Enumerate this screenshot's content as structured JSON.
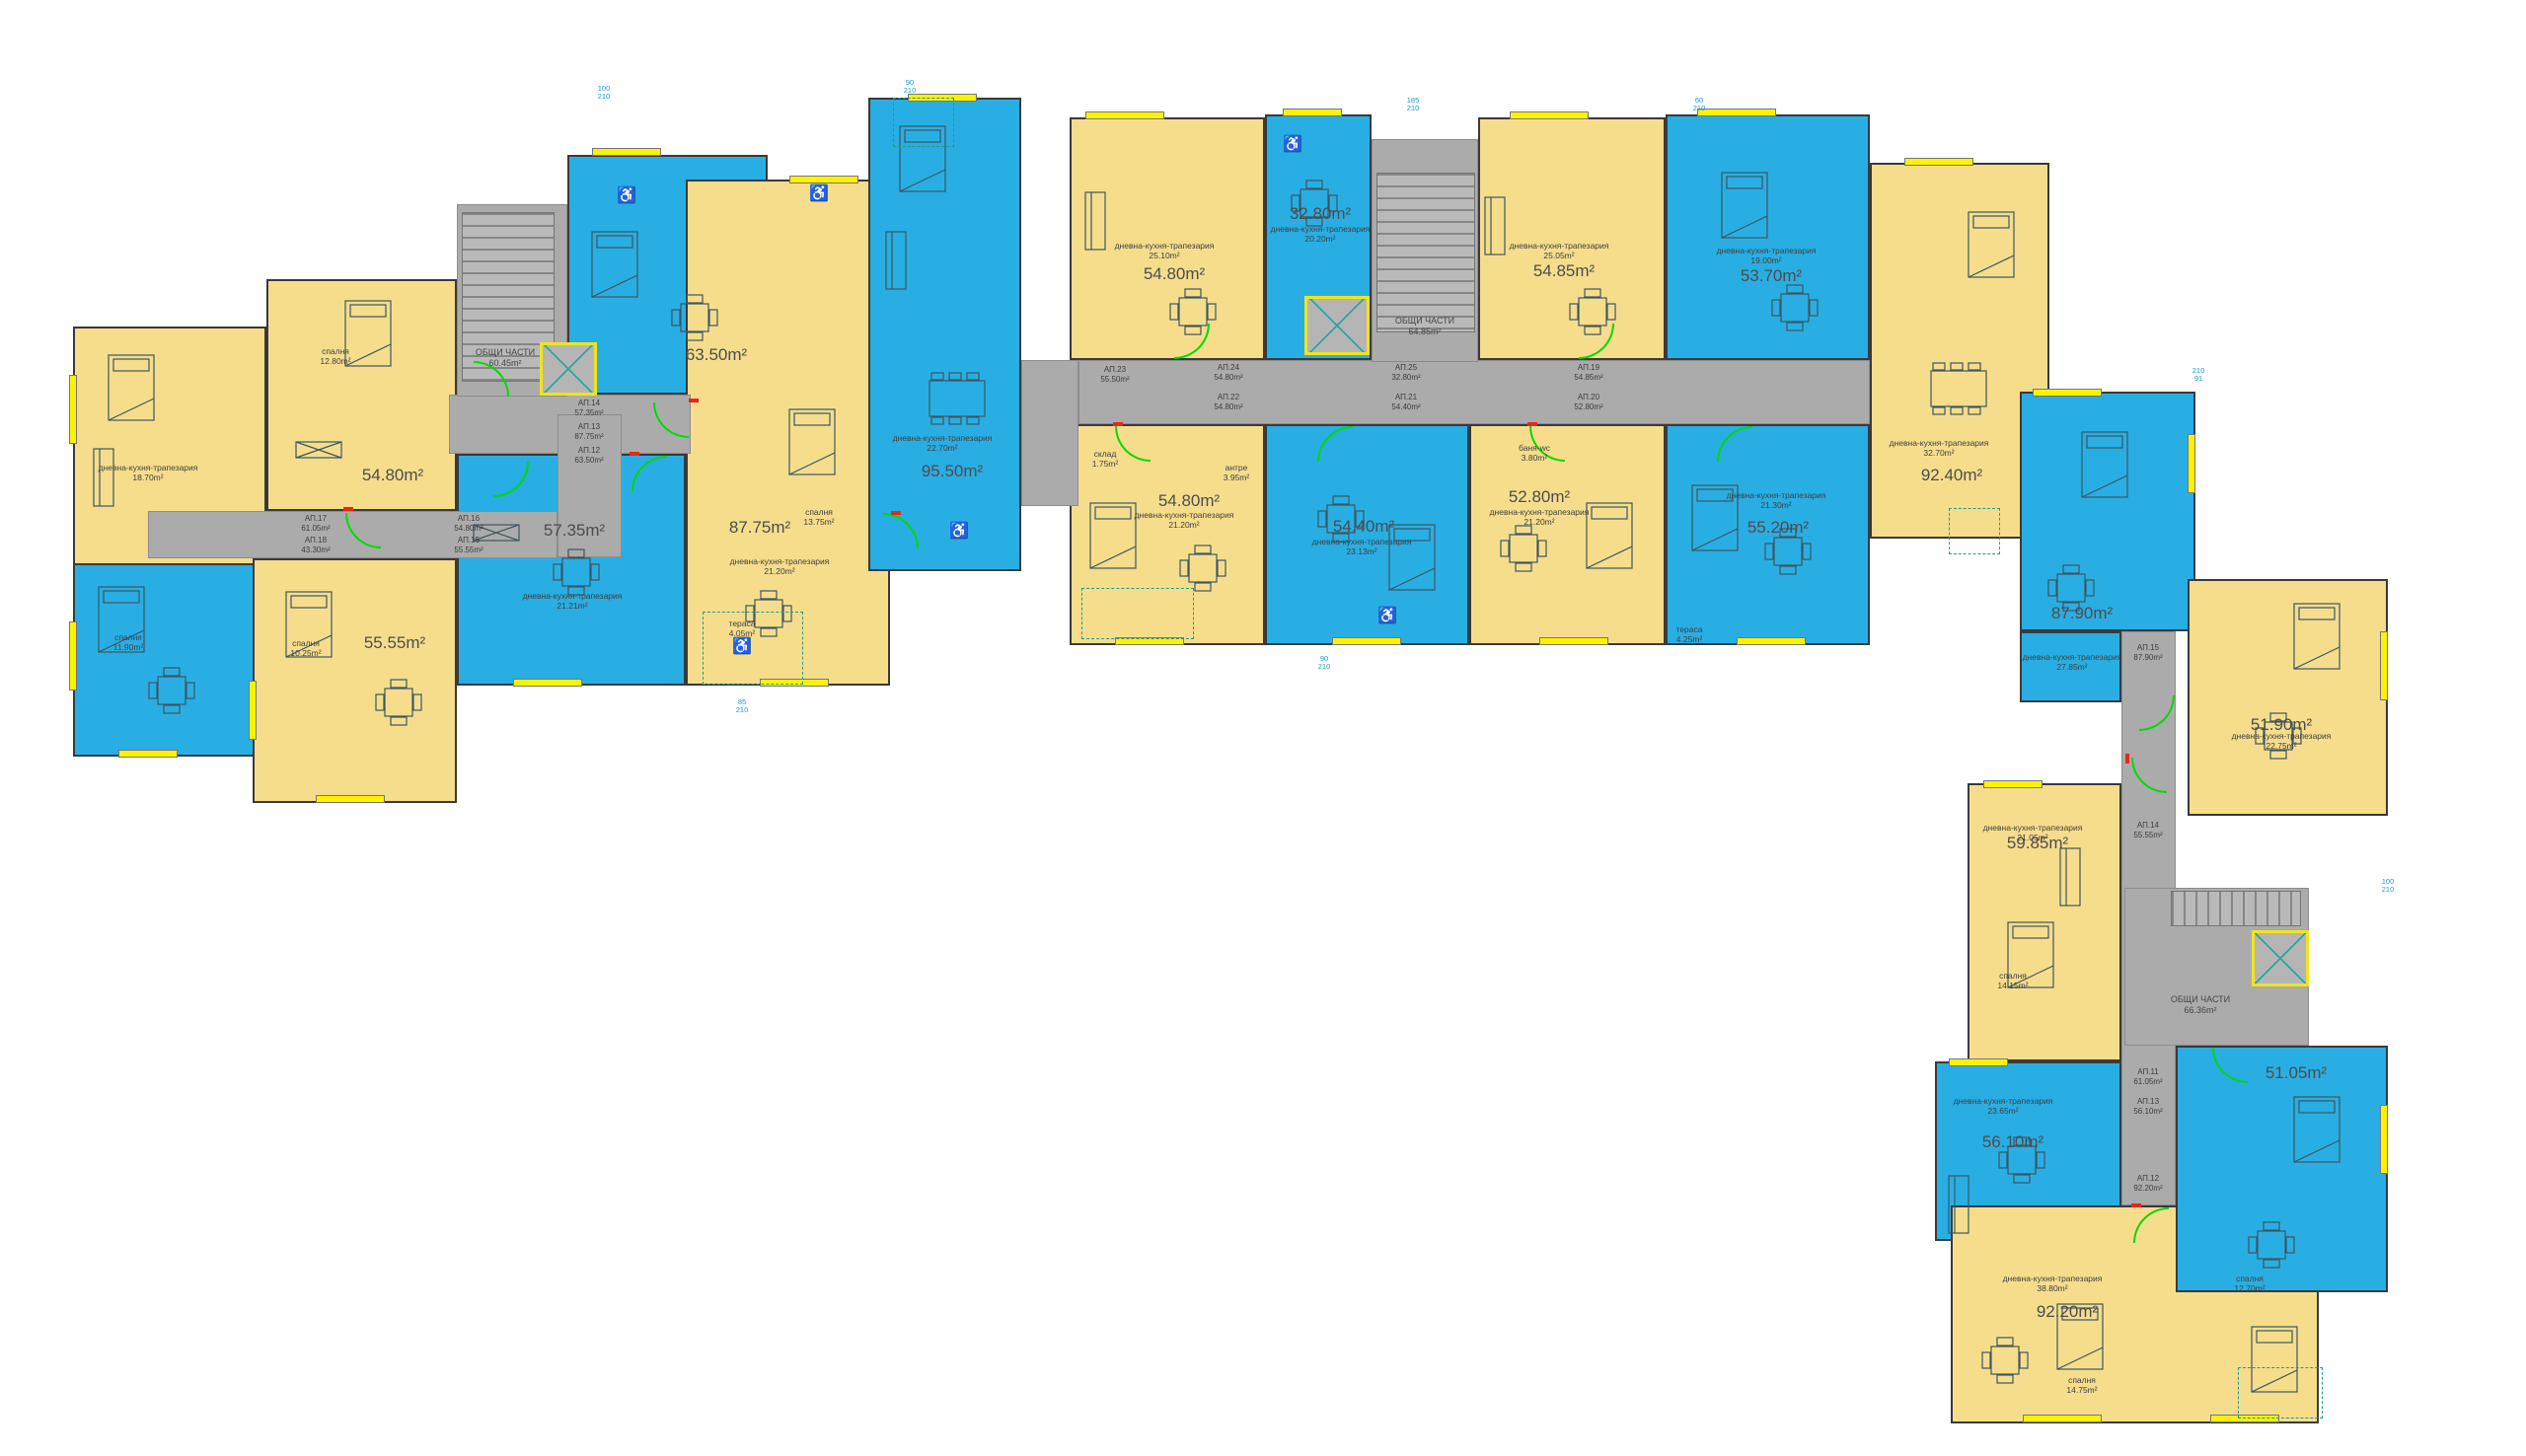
{
  "colors": {
    "apartment_yellow": "#f6dd8c",
    "apartment_blue": "#29aee3",
    "corridor_gray": "#ababab",
    "window_yellow": "#fff200",
    "door_green": "#06d806",
    "accent_red": "#e8271d",
    "dimension_cyan": "#189bd5",
    "wall": "#3a3a3a",
    "label_gray": "#4d4d4d"
  },
  "icons": {
    "wheelchair": "♿"
  },
  "units": [
    {
      "area": "54.80m²"
    },
    {
      "area": "55.55m²"
    },
    {
      "area": "63.50m²"
    },
    {
      "area": "57.35m²"
    },
    {
      "area": "87.75m²"
    },
    {
      "area": "95.50m²"
    },
    {
      "area": "54.80m²"
    },
    {
      "area": "32.80m²"
    },
    {
      "area": "54.85m²"
    },
    {
      "area": "53.70m²"
    },
    {
      "area": "92.40m²"
    },
    {
      "area": "54.80m²"
    },
    {
      "area": "54.40m²"
    },
    {
      "area": "52.80m²"
    },
    {
      "area": "55.20m²"
    },
    {
      "area": "87.90m²"
    },
    {
      "area": "51.90m²"
    },
    {
      "area": "59.85m²"
    },
    {
      "area": "51.05m²"
    },
    {
      "area": "56.10m²"
    },
    {
      "area": "92.20m²"
    }
  ],
  "common_areas": [
    {
      "name": "ОБЩИ ЧАСТИ",
      "area": "60.45m²"
    },
    {
      "name": "ОБЩИ ЧАСТИ",
      "area": "64.85m²"
    },
    {
      "name": "ОБЩИ ЧАСТИ",
      "area": "66.36m²"
    }
  ],
  "corridor_labels": [
    "АП.17\n61.05m²",
    "АП.16\n54.80m²",
    "АП.18\n43.30m²",
    "АП.15\n55.55m²",
    "АП.14\n57.35m²",
    "АП.13\n87.75m²",
    "АП.12\n63.50m²",
    "АП.23\n55.50m²",
    "АП.24\n54.80m²",
    "АП.22\n54.80m²",
    "АП.25\n32.80m²",
    "АП.21\n54.40m²",
    "АП.19\n54.85m²",
    "АП.20\n52.80m²",
    "АП.15\n87.90m²",
    "АП.14\n55.55m²",
    "АП.11\n61.05m²",
    "АП.13\n56.10m²",
    "АП.12\n92.20m²"
  ],
  "room_labels": [
    "спалня\n12.80m²",
    "дневна-кухня-трапезария\n18.70m²",
    "спалня\n10.25m²",
    "дневна-кухня-трапезария\n21.21m²",
    "спалня\n13.75m²",
    "дневна-кухня-трапезария\n21.20m²",
    "дневна-кухня-трапезария\n22.70m²",
    "дневна-кухня-трапезария\n25.10m²",
    "дневна-кухня-трапезария\n20.20m²",
    "дневна-кухня-трапезария\n25.05m²",
    "дневна-кухня-трапезария\n19.00m²",
    "дневна-кухня-трапезария\n32.70m²",
    "дневна-кухня-трапезария\n21.20m²",
    "дневна-кухня-трапезария\n23.13m²",
    "дневна-кухня-трапезария\n21.20m²",
    "дневна-кухня-трапезария\n21.30m²",
    "дневна-кухня-трапезария\n27.85m²",
    "дневна-кухня-трапезария\n22.75m²",
    "дневна-кухня-трапезария\n21.05m²",
    "спалня\n14.15m²",
    "дневна-кухня-трапезария\n23.65m²",
    "дневна-кухня-трапезария\n38.80m²",
    "спалня\n14.75m²",
    "спалня\n12.70m²",
    "антре\n3.95m²",
    "баня-wc\n3.80m²",
    "склад\n1.75m²",
    "тераса\n4.25m²",
    "тераса\n4.05m²",
    "спалня\n11.90m²"
  ],
  "dimension_marks": [
    "100\n210",
    "90\n210",
    "185\n210",
    "60\n210",
    "210\n91",
    "100\n210",
    "85\n210",
    "90\n210"
  ]
}
